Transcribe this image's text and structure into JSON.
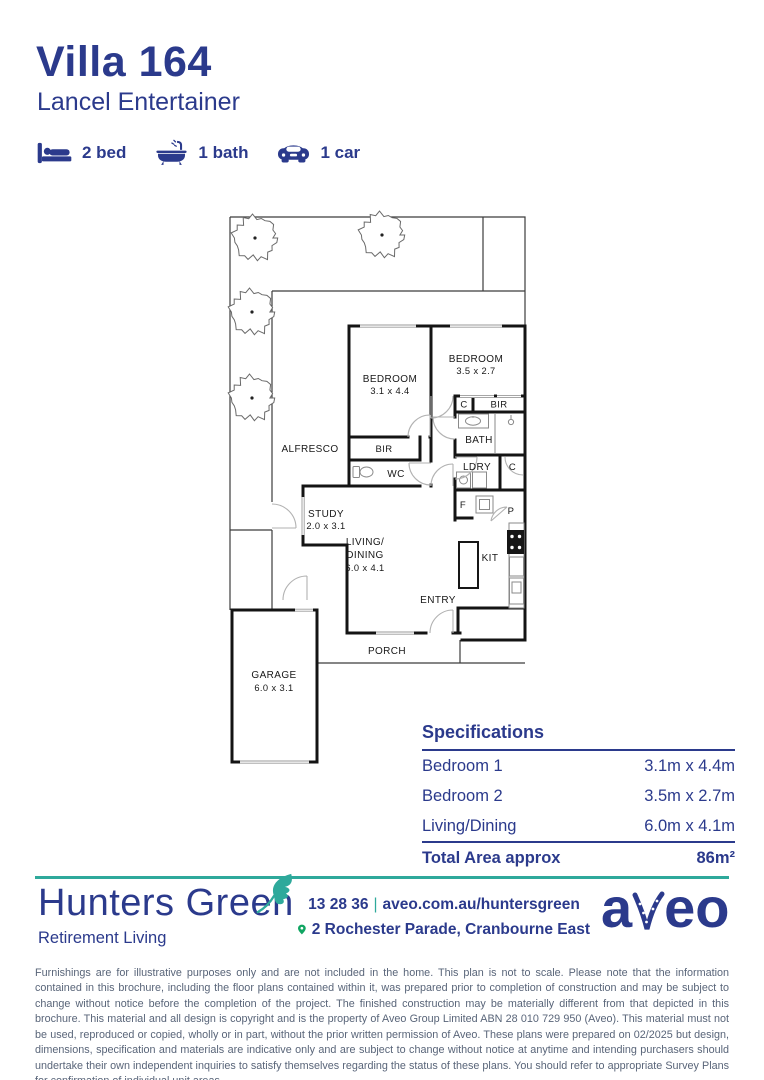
{
  "header": {
    "title": "Villa 164",
    "subtitle": "Lancel Entertainer",
    "features": [
      {
        "icon": "bed-icon",
        "label": "2 bed"
      },
      {
        "icon": "bath-icon",
        "label": "1 bath"
      },
      {
        "icon": "car-icon",
        "label": "1 car"
      }
    ]
  },
  "floorplan": {
    "labels": {
      "alfresco": "ALFRESCO",
      "bedroom1_name": "BEDROOM",
      "bedroom1_dims": "3.1 x 4.4",
      "bedroom2_name": "BEDROOM",
      "bedroom2_dims": "3.5 x 2.7",
      "bir1": "BIR",
      "bir2": "BIR",
      "wc": "WC",
      "bath": "BATH",
      "ldry": "LDRY",
      "c1": "C",
      "c2": "C",
      "f": "F",
      "p": "P",
      "study_name": "STUDY",
      "study_dims": "2.0 x 3.1",
      "living_name1": "LIVING/",
      "living_name2": "DINING",
      "living_dims": "6.0 x 4.1",
      "kit": "KIT",
      "entry": "ENTRY",
      "porch": "PORCH",
      "garage_name": "GARAGE",
      "garage_dims": "6.0 x 3.1"
    }
  },
  "specifications": {
    "heading": "Specifications",
    "rows": [
      {
        "label": "Bedroom 1",
        "value": "3.1m x 4.4m"
      },
      {
        "label": "Bedroom 2",
        "value": "3.5m x 2.7m"
      },
      {
        "label": "Living/Dining",
        "value": "6.0m x 4.1m"
      }
    ],
    "total_label": "Total Area approx",
    "total_value": "86m²"
  },
  "footer": {
    "brand_name": "Hunters Green",
    "brand_tagline": "Retirement Living",
    "phone": "13 28 36",
    "separator": "|",
    "website": "aveo.com.au/huntersgreen",
    "address": "2 Rochester Parade, Cranbourne East",
    "aveo_logo_a": "a",
    "aveo_logo_eo": "eo"
  },
  "disclaimer": "Furnishings are for illustrative purposes only and are not included in the home. This plan is not to scale. Please note that the information contained in this brochure, including the floor plans contained within it, was prepared prior to completion of construction and may be subject to change without notice before the completion of the project. The finished construction may be materially different from that depicted in this brochure. This material and all design is copyright and is the property of Aveo Group Limited ABN 28 010 729 950 (Aveo). This material must not be used, reproduced or copied, wholly or in part, without the prior written permission of Aveo. These plans were prepared on 02/2025 but design, dimensions, specification and materials are indicative only and are subject to change without notice at anytime and intending purchasers should undertake their own independent inquiries to satisfy themselves regarding the status of these plans. You should refer to appropriate Survey Plans for confirmation of individual unit areas.",
  "colors": {
    "navy": "#2b3a8c",
    "teal": "#2ea99b",
    "pin_green": "#10a562",
    "plan_line": "#141414"
  }
}
